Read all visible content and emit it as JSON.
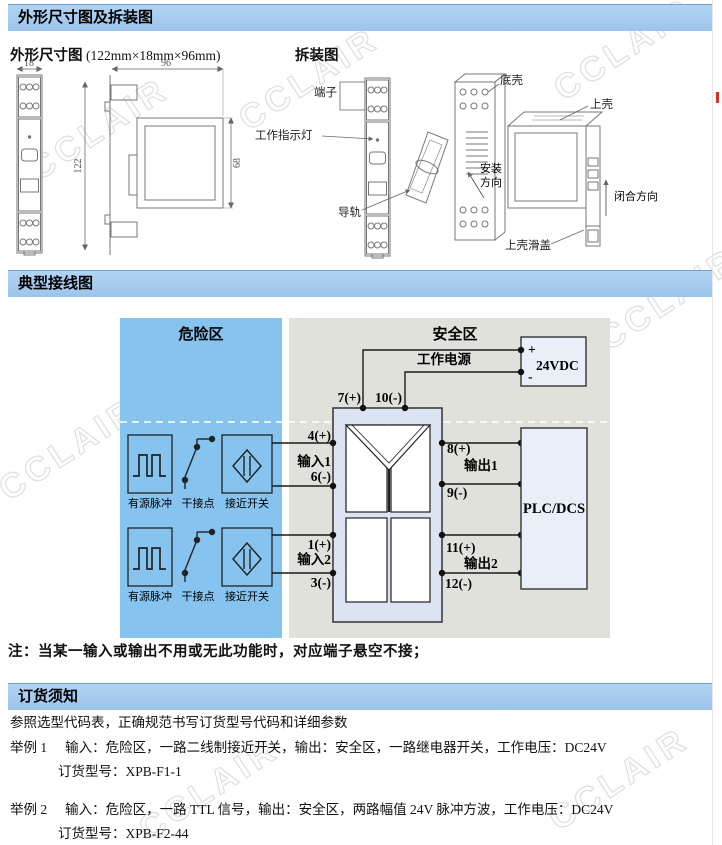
{
  "sections": {
    "s1": "外形尺寸图及拆装图",
    "s2": "典型接线图",
    "s3": "订货须知"
  },
  "outline": {
    "title": "外形尺寸图",
    "size": "(122mm×18mm×96mm)",
    "dims": {
      "width": "18",
      "depth": "96",
      "height": "122",
      "body": "68"
    }
  },
  "disassembly": {
    "title": "拆装图",
    "terminal": "端子",
    "indicator": "工作指示灯",
    "rail": "导轨",
    "bottom_shell": "底壳",
    "top_shell": "上壳",
    "install_dir_1": "安装",
    "install_dir_2": "方向",
    "close_dir": "闭合方向",
    "top_cover": "上壳滑盖"
  },
  "wiring": {
    "hazard_zone": "危险区",
    "safe_zone": "安全区",
    "power_label": "工作电源",
    "plus": "+",
    "minus": "-",
    "supply": "24VDC",
    "plc": "PLC/DCS",
    "t7": "7(+)",
    "t10": "10(-)",
    "t4": "4(+)",
    "t6": "6(-)",
    "in1": "输入1",
    "t1": "1(+)",
    "t3": "3(-)",
    "in2": "输入2",
    "t8": "8(+)",
    "t9": "9(-)",
    "out1": "输出1",
    "t11": "11(+)",
    "t12": "12(-)",
    "out2": "输出2",
    "src_pulse": "有源脉冲",
    "src_contact": "干接点",
    "src_proximity": "接近开关"
  },
  "note": "注：当某一输入或输出不用或无此功能时，对应端子悬空不接；",
  "ordering": {
    "intro": "参照选型代码表，正确规范书写订货型号代码和详细参数",
    "examples": [
      {
        "label": "举例 1",
        "desc": "输入：危险区，一路二线制接近开关，输出：安全区，一路继电器开关，工作电压：DC24V",
        "model": "订货型号：XPB-F1-1"
      },
      {
        "label": "举例 2",
        "desc": "输入：危险区，一路 TTL 信号，输出：安全区，两路幅值 24V 脉冲方波，工作电压：DC24V",
        "model": "订货型号：XPB-F2-44"
      }
    ]
  },
  "watermark": "CCLAIR",
  "colors": {
    "header_bar": "#a9cdf0",
    "hazard_fill": "#86c3ef",
    "safe_fill": "#e1e1db",
    "device_fill": "#dce3f3",
    "box_fill": "#e9eef8",
    "red_mark": "#d63322"
  }
}
